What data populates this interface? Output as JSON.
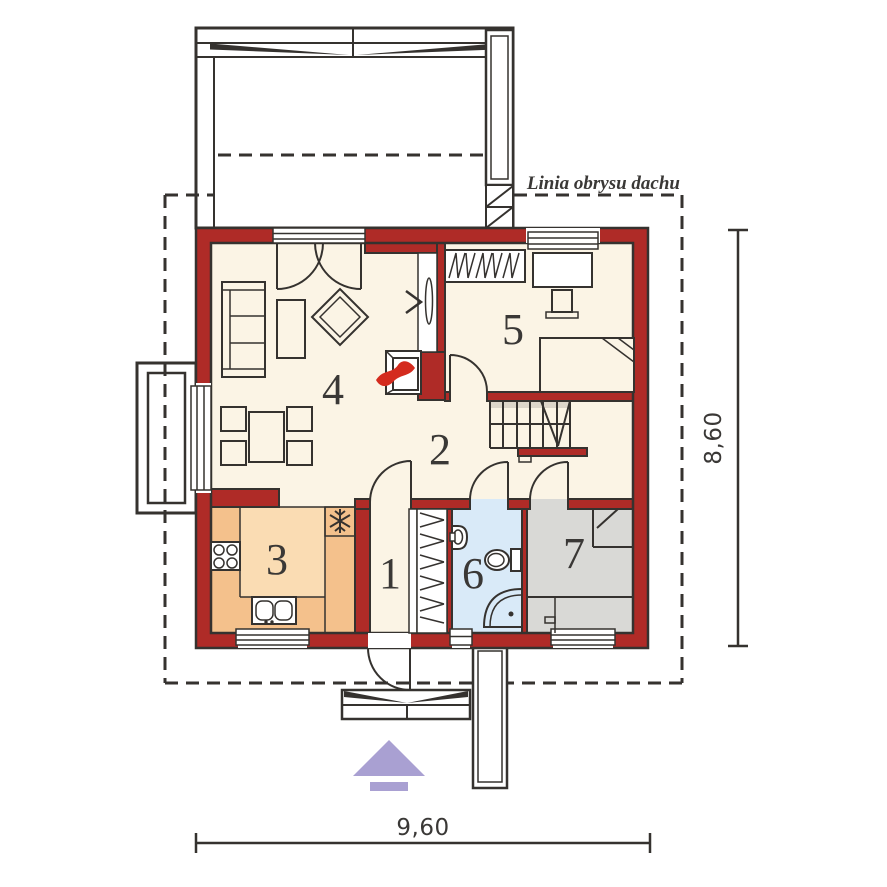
{
  "labels": {
    "roof_outline": "Linia obrysu dachu",
    "dim_width": "9,60",
    "dim_height": "8,60"
  },
  "rooms": [
    {
      "number": "1"
    },
    {
      "number": "2"
    },
    {
      "number": "3"
    },
    {
      "number": "4"
    },
    {
      "number": "5"
    },
    {
      "number": "6"
    },
    {
      "number": "7"
    }
  ],
  "colors": {
    "wall": "#AF2B27",
    "line": "#35322F",
    "floor": "#FBF4E5",
    "kitchen_counter": "#F4C18C",
    "kitchen_floor": "#FADCB3",
    "bath": "#D9EAF8",
    "utility": "#D9D9D6",
    "fireplace_yellow": "#FCE23E",
    "flame": "#D42B1E",
    "arrow": "#A9A0D2",
    "text_color": "#3A3836",
    "background": "#FFFFFF"
  }
}
